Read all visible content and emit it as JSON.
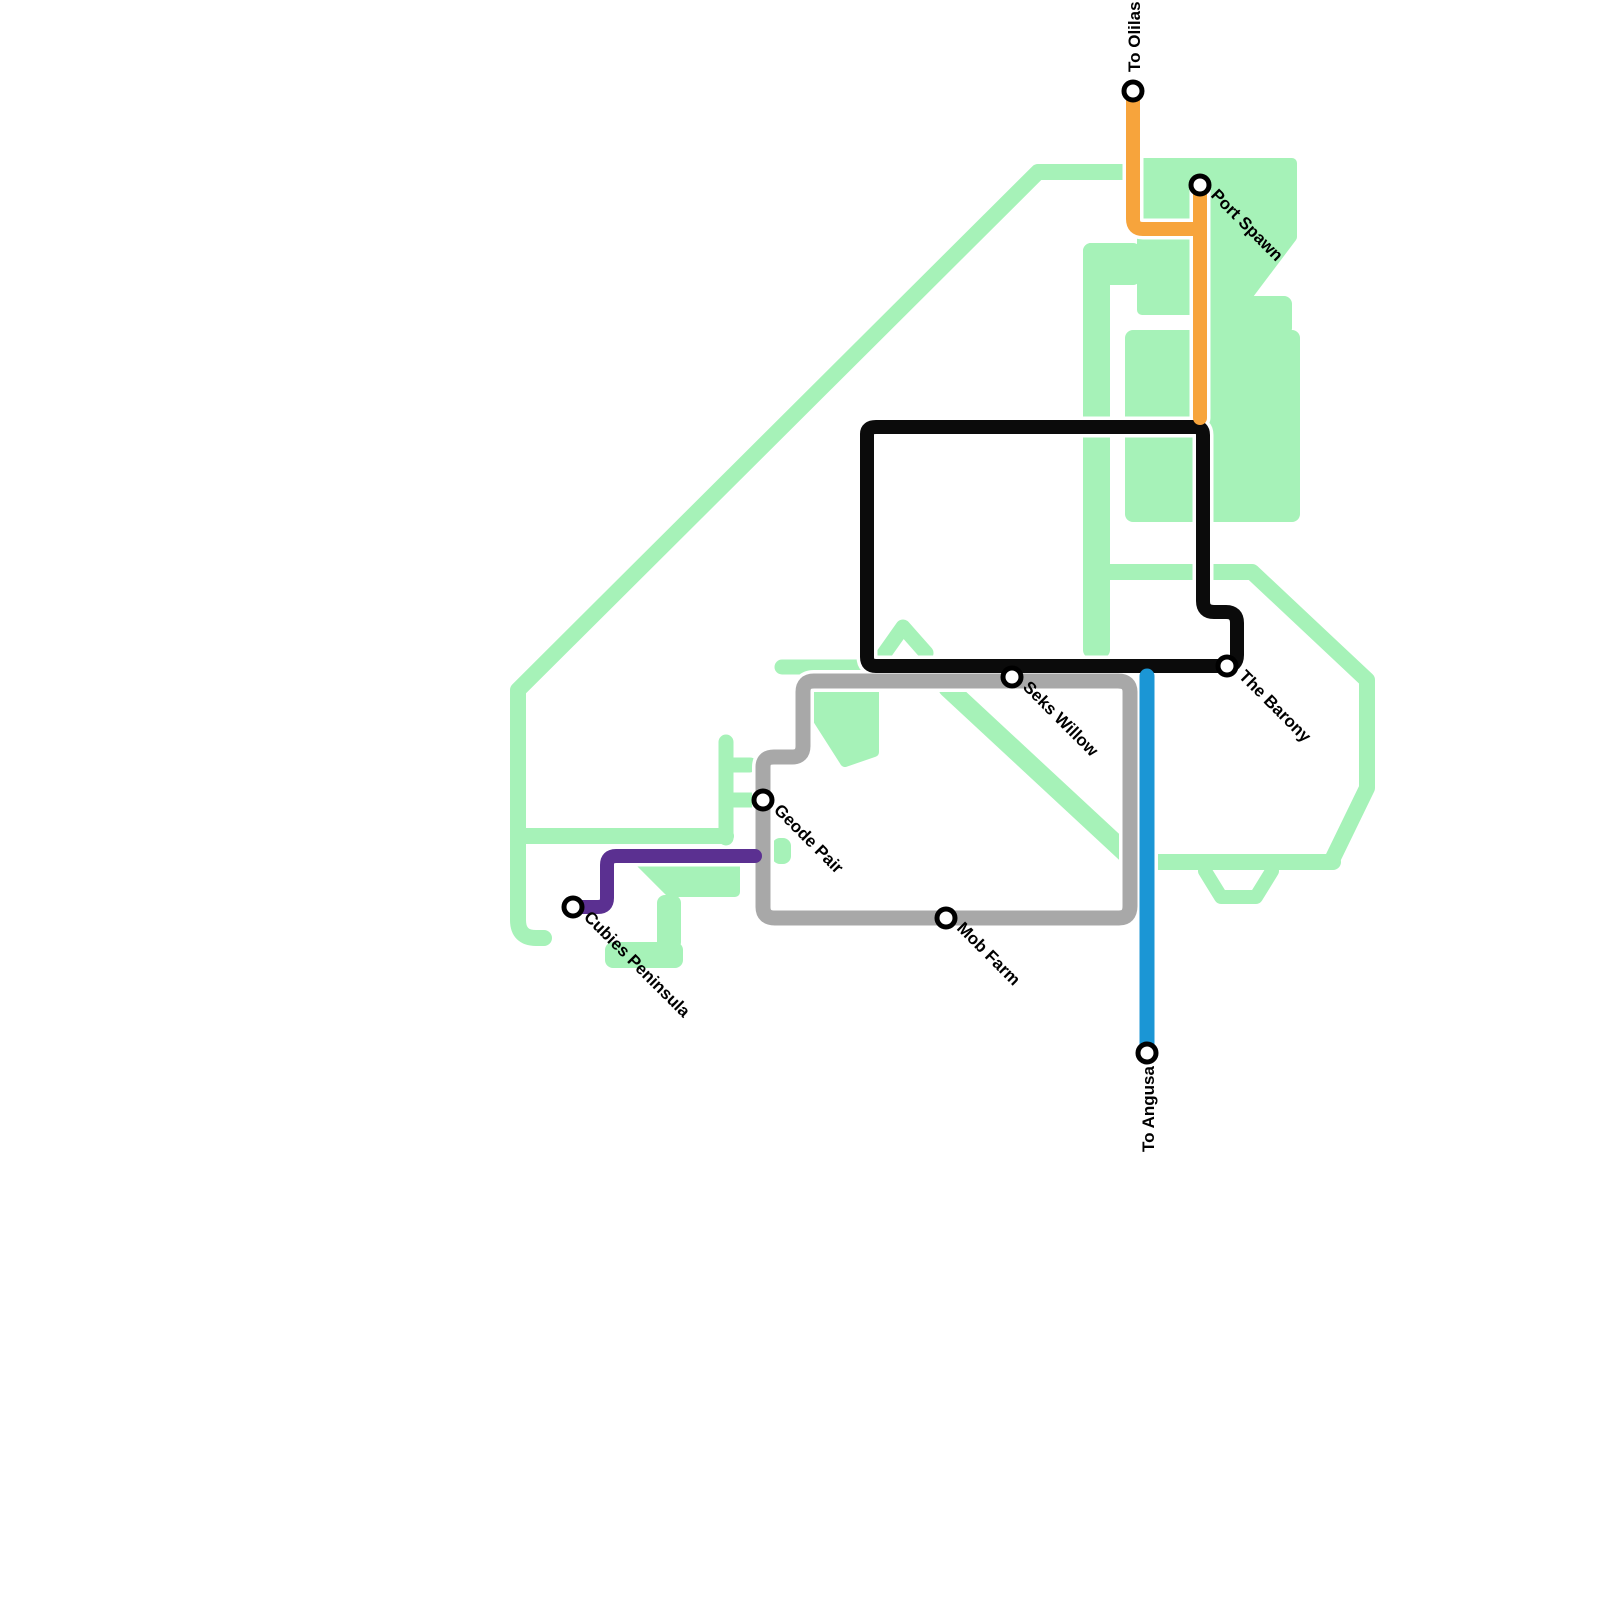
{
  "map": {
    "background": "#ffffff",
    "green_color": "#a6f2b8",
    "casing_color": "#ffffff",
    "station_style": {
      "radius": 9,
      "ring_color": "#000000",
      "fill": "#ffffff",
      "ring_width": 5
    },
    "green_shapes": [
      {
        "name": "landmass-border-west",
        "kind": "path",
        "d": "M1123,172 H1038 L518,690 V920 Q518,938 536,938 H544",
        "w": 16
      },
      {
        "name": "landmass-branch-south",
        "kind": "path",
        "d": "M520,836 H726",
        "w": 16
      },
      {
        "name": "geode-steps",
        "kind": "path",
        "d": "M726,838 V742 M726,765 H750 M734,800 H752",
        "w": 15
      },
      {
        "name": "geode-east-patch",
        "kind": "rect",
        "x": 772,
        "y": 838,
        "wd": 19,
        "ht": 26
      },
      {
        "name": "cubies-blob-a",
        "kind": "rect",
        "x": 605,
        "y": 942,
        "wd": 78,
        "ht": 26
      },
      {
        "name": "cubies-blob-b",
        "kind": "rect",
        "x": 657,
        "y": 895,
        "wd": 24,
        "ht": 55
      },
      {
        "name": "under-purple-blob",
        "kind": "polygon",
        "pts": "640,862 735,862 735,892 670,892"
      },
      {
        "name": "seks-diagonal",
        "kind": "path",
        "d": "M948,688 L1130,857",
        "w": 19
      },
      {
        "name": "gray-loop-triangle",
        "kind": "polygon",
        "pts": "808,688 874,688 874,752 845,762 808,704"
      },
      {
        "name": "black-bottom-west-segment",
        "kind": "path",
        "d": "M782,667 H858",
        "w": 15
      },
      {
        "name": "peak-inside-black",
        "kind": "path",
        "d": "M874,668 L903,627 L926,653",
        "w": 15
      },
      {
        "name": "central-vertical-band",
        "kind": "rect",
        "x": 1083,
        "y": 243,
        "wd": 27,
        "ht": 415
      },
      {
        "name": "central-band-cap",
        "kind": "rect",
        "x": 1083,
        "y": 243,
        "wd": 58,
        "ht": 42
      },
      {
        "name": "port-spawn-blob",
        "kind": "polygon",
        "pts": "1142,163 1292,163 1292,237 1237,310 1142,310"
      },
      {
        "name": "east-big-block",
        "kind": "rect",
        "x": 1125,
        "y": 330,
        "wd": 175,
        "ht": 192
      },
      {
        "name": "east-block-north-arm",
        "kind": "rect",
        "x": 1210,
        "y": 296,
        "wd": 82,
        "ht": 40
      },
      {
        "name": "barony-hexagon",
        "kind": "path",
        "d": "M1093,572 H1252 L1367,680 V788 L1333,858",
        "w": 16
      },
      {
        "name": "boat-band",
        "kind": "path",
        "d": "M1333,862 H1158",
        "w": 16
      },
      {
        "name": "boat-trapezoid",
        "kind": "path",
        "d": "M1205,871 L1221,897 H1256 L1272,871",
        "w": 14
      },
      {
        "name": "south-stub",
        "kind": "path",
        "d": "M1046,917 H1112",
        "w": 15
      }
    ],
    "lines": [
      {
        "name": "gray-line",
        "color": "#a8a8a8",
        "w": 15,
        "d": "M803,692 Q803,681 814,681 H1118 Q1130,681 1130,692 V906 Q1130,918 1119,918 H775 Q763,918 763,907 V767 Q763,757 774,757 H792 Q803,757 803,746 Z"
      },
      {
        "name": "black-line",
        "color": "#0b0b0b",
        "w": 14,
        "d": "M867,434 Q867,427 876,427 H1195 Q1203,427 1203,435 V601 Q1203,612 1214,612 H1226 Q1237,612 1237,623 V655 Q1237,666 1226,666 H876 Q867,666 867,657 Z"
      },
      {
        "name": "orange-line",
        "color": "#f7a43c",
        "w": 14,
        "d": "M1133,91 V219 Q1133,229 1143,229 H1200 M1200,186 V418"
      },
      {
        "name": "blue-line",
        "color": "#1b96d5",
        "w": 15,
        "d": "M1147,676 V1053"
      },
      {
        "name": "purple-line",
        "color": "#5b3091",
        "w": 14,
        "d": "M573,907 H598 Q607,907 607,898 V865 Q607,856 616,856 H755"
      }
    ],
    "stations": [
      {
        "label": "To Olilas",
        "x": 1133,
        "y": 91,
        "lx": 1140,
        "ly": 72,
        "rot": -90
      },
      {
        "label": "Port Spawn",
        "x": 1200,
        "y": 185,
        "lx": 1210,
        "ly": 196,
        "rot": 45
      },
      {
        "label": "The Barony",
        "x": 1227,
        "y": 666,
        "lx": 1238,
        "ly": 677,
        "rot": 45
      },
      {
        "label": "Seks Willow",
        "x": 1012,
        "y": 677,
        "lx": 1022,
        "ly": 688,
        "rot": 45
      },
      {
        "label": "Geode Pair",
        "x": 763,
        "y": 800,
        "lx": 773,
        "ly": 811,
        "rot": 45
      },
      {
        "label": "Mob Farm",
        "x": 946,
        "y": 918,
        "lx": 956,
        "ly": 929,
        "rot": 45
      },
      {
        "label": "Cubies Peninsula",
        "x": 573,
        "y": 907,
        "lx": 583,
        "ly": 918,
        "rot": 45
      },
      {
        "label": "To Angusa",
        "x": 1147,
        "y": 1053,
        "lx": 1154,
        "ly": 1152,
        "rot": -90
      }
    ]
  }
}
